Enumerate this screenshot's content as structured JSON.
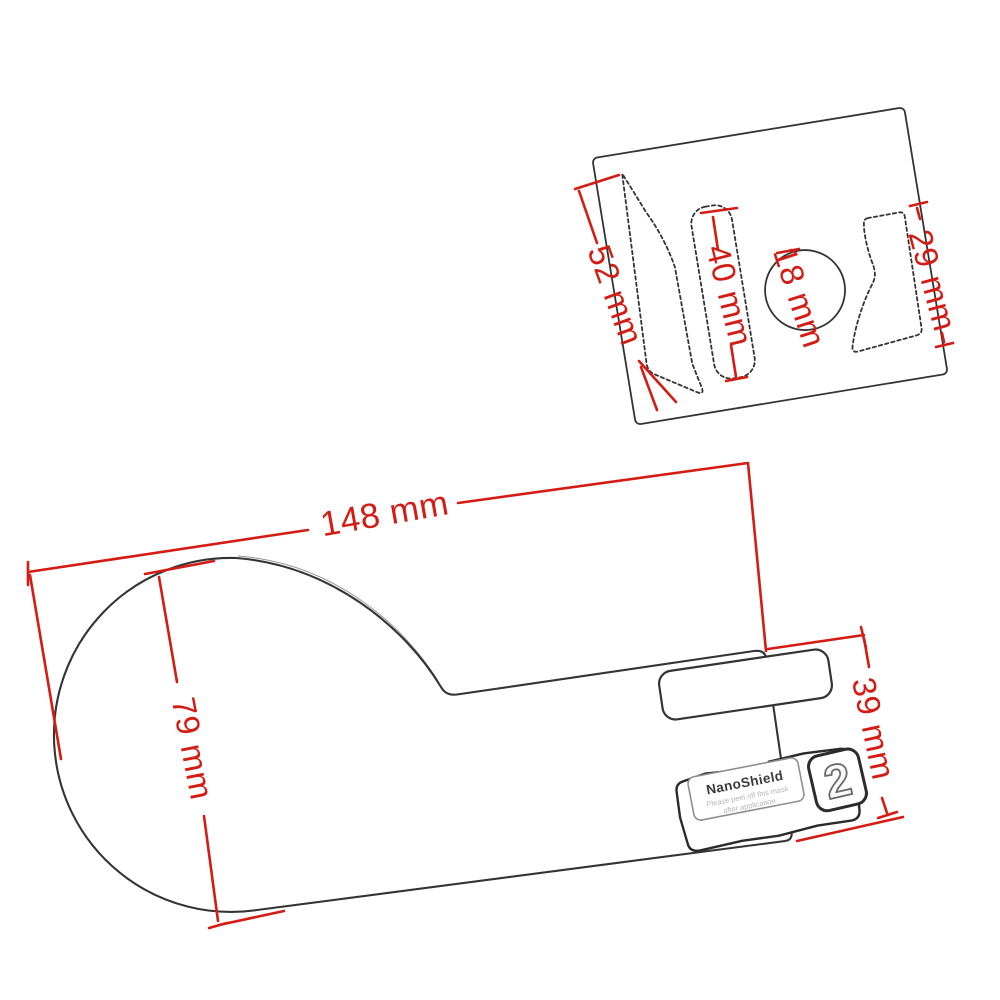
{
  "colors": {
    "background": "#ffffff",
    "dimension_red": "#d41c14",
    "outline_ink": "#343434",
    "note_gray": "#b6b6b6"
  },
  "sheet": {
    "dims": {
      "d52": "52 mm",
      "d40": "40 mm",
      "d18": "18 mm",
      "d29": "29 mm"
    }
  },
  "protector": {
    "dims": {
      "d148": "148 mm",
      "d79": "79 mm",
      "d39": "39 mm"
    },
    "sticker": {
      "brand": "NanoShield",
      "note_line1": "Please peel off this mask",
      "note_line2": "after application"
    },
    "badge": "2"
  }
}
